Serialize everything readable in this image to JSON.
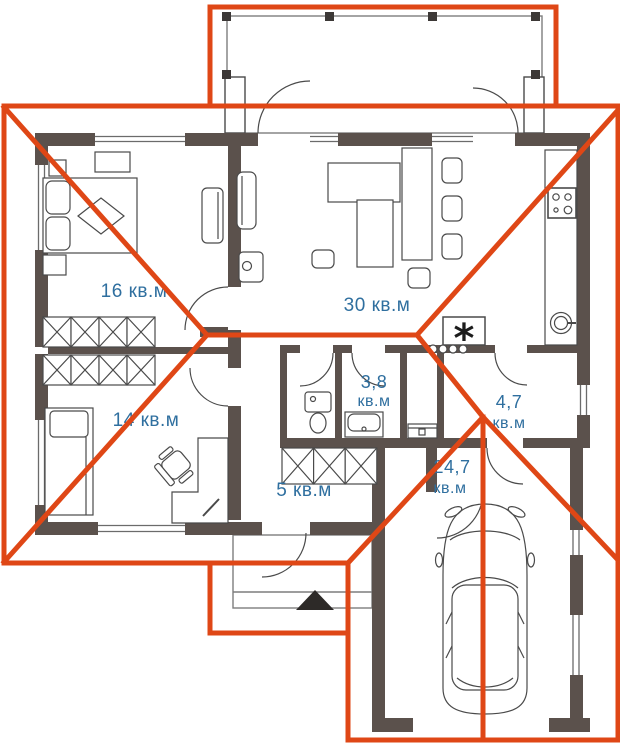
{
  "plan": {
    "colors": {
      "roof": "#df4716",
      "wall": "#5b514c",
      "label": "#2f6f9f",
      "outline": "#4a4a4a"
    },
    "labels": {
      "bedroom_large": "16 кв.м",
      "living": "30 кв.м",
      "bedroom_small": "14 кв.м",
      "hallway": "5 кв.м",
      "bathroom_value": "3,8",
      "bathroom_unit": "кв.м",
      "entry_value": "4,7",
      "entry_unit": "кв.м",
      "garage_value": "24,7",
      "garage_unit": "кв.м",
      "boiler_symbol": "*"
    }
  }
}
